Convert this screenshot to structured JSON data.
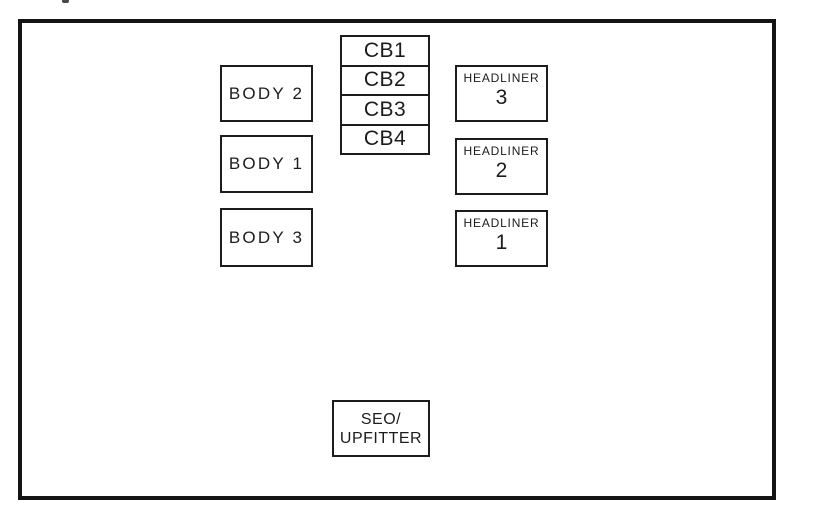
{
  "diagram": {
    "colors": {
      "line": "#1c1c1c",
      "outer_border": "#141414",
      "background": "#ffffff"
    },
    "body_boxes": [
      {
        "label": "BODY 2"
      },
      {
        "label": "BODY 1"
      },
      {
        "label": "BODY 3"
      }
    ],
    "cb_stack": [
      {
        "label": "CB1"
      },
      {
        "label": "CB2"
      },
      {
        "label": "CB3"
      },
      {
        "label": "CB4"
      }
    ],
    "headliner_boxes": [
      {
        "label": "HEADLINER",
        "number": "3"
      },
      {
        "label": "HEADLINER",
        "number": "2"
      },
      {
        "label": "HEADLINER",
        "number": "1"
      }
    ],
    "seo_upfitter_box": {
      "line1": "SEO/",
      "line2": "UPFITTER"
    }
  }
}
